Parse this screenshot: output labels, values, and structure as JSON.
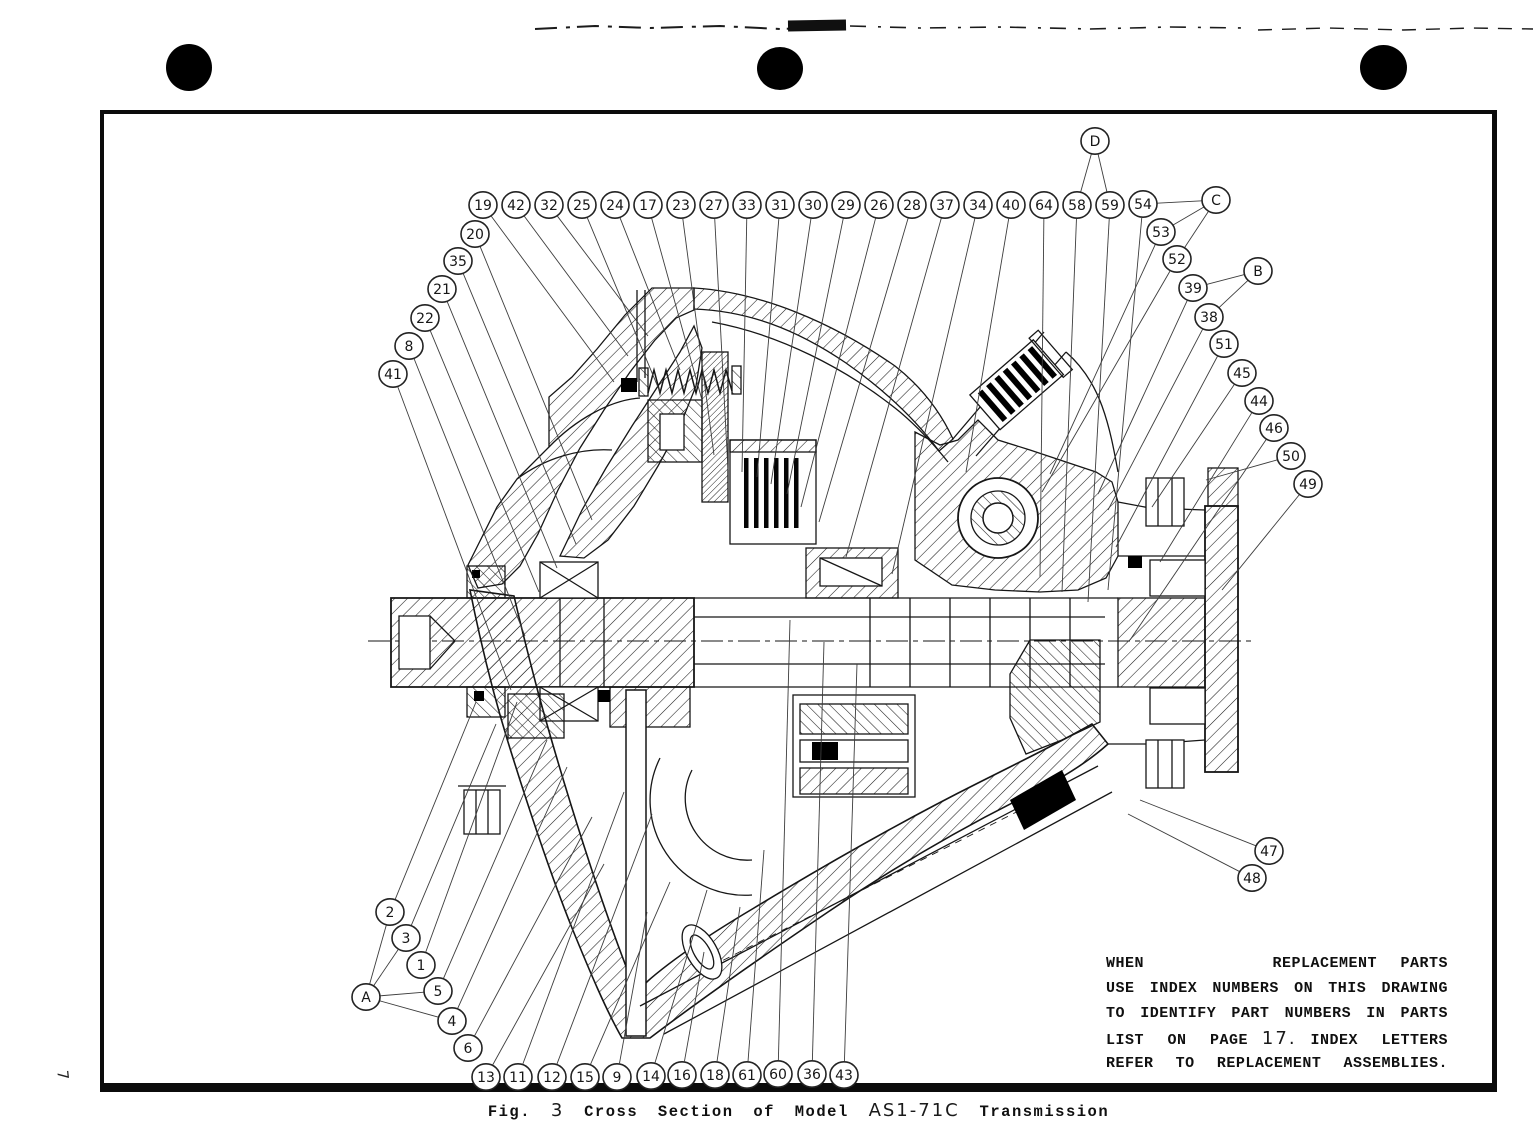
{
  "page": {
    "margin_page_number": "7"
  },
  "note": {
    "line1_left": "WHEN",
    "line1_right": "REPLACEMENT PARTS",
    "line2": "USE INDEX NUMBERS ON THIS DRAWING",
    "line3": "TO IDENTIFY PART NUMBERS IN PARTS",
    "line4_pre": "LIST ON PAGE",
    "line4_page": "17.",
    "line4_post": "INDEX LETTERS",
    "line5": "REFER TO REPLACEMENT ASSEMBLIES."
  },
  "figure": {
    "caption_prefix": "Fig.",
    "caption_number": "3",
    "caption_body": "Cross Section of Model",
    "caption_model": "AS1-71C",
    "caption_suffix": "Transmission"
  },
  "callouts": [
    {
      "label": "19",
      "x": 483,
      "y": 205,
      "tx": 614,
      "ty": 382
    },
    {
      "label": "42",
      "x": 516,
      "y": 205,
      "tx": 628,
      "ty": 356
    },
    {
      "label": "32",
      "x": 549,
      "y": 205,
      "tx": 648,
      "ty": 336
    },
    {
      "label": "25",
      "x": 582,
      "y": 205,
      "tx": 660,
      "ty": 392
    },
    {
      "label": "24",
      "x": 615,
      "y": 205,
      "tx": 680,
      "ty": 370
    },
    {
      "label": "17",
      "x": 648,
      "y": 205,
      "tx": 702,
      "ty": 400
    },
    {
      "label": "23",
      "x": 681,
      "y": 205,
      "tx": 714,
      "ty": 455
    },
    {
      "label": "27",
      "x": 714,
      "y": 205,
      "tx": 728,
      "ty": 470
    },
    {
      "label": "33",
      "x": 747,
      "y": 205,
      "tx": 742,
      "ty": 472
    },
    {
      "label": "31",
      "x": 780,
      "y": 205,
      "tx": 757,
      "ty": 477
    },
    {
      "label": "30",
      "x": 813,
      "y": 205,
      "tx": 771,
      "ty": 484
    },
    {
      "label": "29",
      "x": 846,
      "y": 205,
      "tx": 787,
      "ty": 494
    },
    {
      "label": "26",
      "x": 879,
      "y": 205,
      "tx": 801,
      "ty": 507
    },
    {
      "label": "28",
      "x": 912,
      "y": 205,
      "tx": 819,
      "ty": 522
    },
    {
      "label": "37",
      "x": 945,
      "y": 205,
      "tx": 846,
      "ty": 557
    },
    {
      "label": "34",
      "x": 978,
      "y": 205,
      "tx": 892,
      "ty": 574
    },
    {
      "label": "40",
      "x": 1011,
      "y": 205,
      "tx": 966,
      "ty": 472
    },
    {
      "label": "64",
      "x": 1044,
      "y": 205,
      "tx": 1040,
      "ty": 577
    },
    {
      "label": "58",
      "x": 1077,
      "y": 205,
      "tx": 1062,
      "ty": 592
    },
    {
      "label": "59",
      "x": 1110,
      "y": 205,
      "tx": 1088,
      "ty": 602
    },
    {
      "label": "54",
      "x": 1143,
      "y": 204,
      "tx": 1108,
      "ty": 590
    },
    {
      "label": "D",
      "type": "letter",
      "x": 1095,
      "y": 141,
      "connects": [
        "58",
        "59"
      ]
    },
    {
      "label": "C",
      "type": "letter",
      "x": 1216,
      "y": 200,
      "connects": [
        "54",
        "53",
        "52"
      ]
    },
    {
      "label": "B",
      "type": "letter",
      "x": 1258,
      "y": 271,
      "connects": [
        "39",
        "38"
      ]
    },
    {
      "label": "53",
      "x": 1161,
      "y": 232,
      "tx": 1050,
      "ty": 474
    },
    {
      "label": "52",
      "x": 1177,
      "y": 259,
      "tx": 1042,
      "ty": 492
    },
    {
      "label": "39",
      "x": 1193,
      "y": 288,
      "tx": 1098,
      "ty": 494
    },
    {
      "label": "38",
      "x": 1209,
      "y": 317,
      "tx": 1108,
      "ty": 510
    },
    {
      "label": "51",
      "x": 1224,
      "y": 344,
      "tx": 1116,
      "ty": 547
    },
    {
      "label": "45",
      "x": 1242,
      "y": 373,
      "tx": 1152,
      "ty": 507
    },
    {
      "label": "44",
      "x": 1259,
      "y": 401,
      "tx": 1160,
      "ty": 562
    },
    {
      "label": "46",
      "x": 1274,
      "y": 428,
      "tx": 1130,
      "ty": 640
    },
    {
      "label": "50",
      "x": 1291,
      "y": 456,
      "tx": 1206,
      "ty": 480
    },
    {
      "label": "49",
      "x": 1308,
      "y": 484,
      "tx": 1222,
      "ty": 590
    },
    {
      "label": "20",
      "x": 475,
      "y": 234,
      "tx": 592,
      "ty": 520
    },
    {
      "label": "35",
      "x": 458,
      "y": 261,
      "tx": 576,
      "ty": 544
    },
    {
      "label": "21",
      "x": 442,
      "y": 289,
      "tx": 557,
      "ty": 568
    },
    {
      "label": "22",
      "x": 425,
      "y": 318,
      "tx": 539,
      "ty": 592
    },
    {
      "label": "8",
      "x": 409,
      "y": 346,
      "tx": 525,
      "ty": 636
    },
    {
      "label": "41",
      "x": 393,
      "y": 374,
      "tx": 511,
      "ty": 690
    },
    {
      "label": "2",
      "x": 390,
      "y": 912,
      "tx": 476,
      "ty": 702
    },
    {
      "label": "3",
      "x": 406,
      "y": 938,
      "tx": 496,
      "ty": 724
    },
    {
      "label": "1",
      "x": 421,
      "y": 965,
      "tx": 517,
      "ty": 702
    },
    {
      "label": "5",
      "x": 438,
      "y": 991,
      "tx": 547,
      "ty": 740
    },
    {
      "label": "A",
      "type": "letter",
      "x": 366,
      "y": 997,
      "connects": [
        "2",
        "3",
        "5",
        "4"
      ]
    },
    {
      "label": "4",
      "x": 452,
      "y": 1021,
      "tx": 567,
      "ty": 767
    },
    {
      "label": "6",
      "x": 468,
      "y": 1048,
      "tx": 592,
      "ty": 817
    },
    {
      "label": "13",
      "x": 486,
      "y": 1077,
      "tx": 604,
      "ty": 864
    },
    {
      "label": "11",
      "x": 518,
      "y": 1077,
      "tx": 624,
      "ty": 792
    },
    {
      "label": "12",
      "x": 552,
      "y": 1077,
      "tx": 652,
      "ty": 814
    },
    {
      "label": "15",
      "x": 585,
      "y": 1077,
      "tx": 670,
      "ty": 882
    },
    {
      "label": "9",
      "x": 617,
      "y": 1077,
      "tx": 647,
      "ty": 912
    },
    {
      "label": "14",
      "x": 651,
      "y": 1076,
      "tx": 707,
      "ty": 890
    },
    {
      "label": "16",
      "x": 682,
      "y": 1075,
      "tx": 704,
      "ty": 952
    },
    {
      "label": "18",
      "x": 715,
      "y": 1075,
      "tx": 740,
      "ty": 907
    },
    {
      "label": "61",
      "x": 747,
      "y": 1075,
      "tx": 764,
      "ty": 850
    },
    {
      "label": "60",
      "x": 778,
      "y": 1074,
      "tx": 790,
      "ty": 620
    },
    {
      "label": "36",
      "x": 812,
      "y": 1074,
      "tx": 824,
      "ty": 642
    },
    {
      "label": "43",
      "x": 844,
      "y": 1075,
      "tx": 857,
      "ty": 664
    },
    {
      "label": "47",
      "x": 1269,
      "y": 851,
      "tx": 1140,
      "ty": 800
    },
    {
      "label": "48",
      "x": 1252,
      "y": 878,
      "tx": 1128,
      "ty": 814
    }
  ]
}
